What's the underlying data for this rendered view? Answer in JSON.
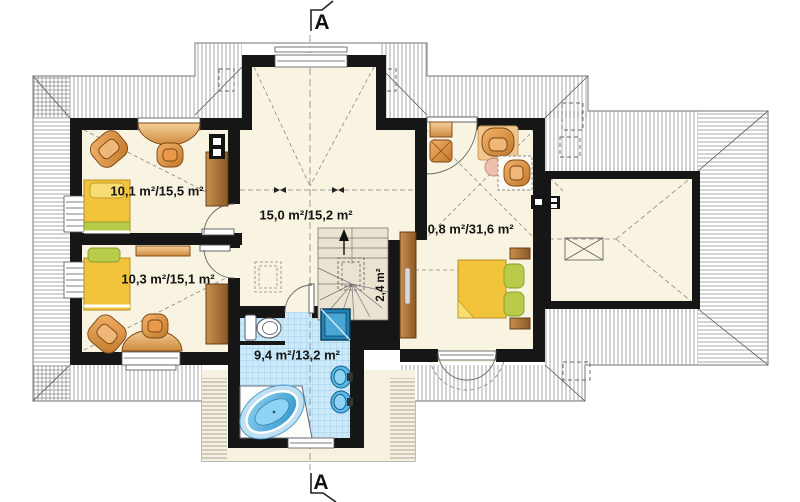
{
  "plan": {
    "type": "attic-floor-plan",
    "rooms": {
      "top_left": {
        "label": "10,1 m²/15,5 m²"
      },
      "bottom_left": {
        "label": "10,3 m²/15,1 m²"
      },
      "hall": {
        "label": "15,0 m²/15,2 m²"
      },
      "bedroom": {
        "label": "20,8 m²/31,6 m²"
      },
      "bathroom": {
        "label": "9,4 m²/13,2 m²"
      },
      "stairs": {
        "label": "2,4 m²"
      }
    },
    "section_markers": {
      "top": "A",
      "bottom": "A"
    },
    "colors": {
      "wall": "#161616",
      "floor": "#f9f3e2",
      "stair_floor": "#eae3d2",
      "tile": "#cde9f7",
      "furniture_orange": "#d98a3a",
      "bed_yellow": "#f2c43c",
      "pillow_green": "#b8cc4a",
      "fixture_blue": "#4fb3e3",
      "roof_line": "#777777"
    }
  }
}
